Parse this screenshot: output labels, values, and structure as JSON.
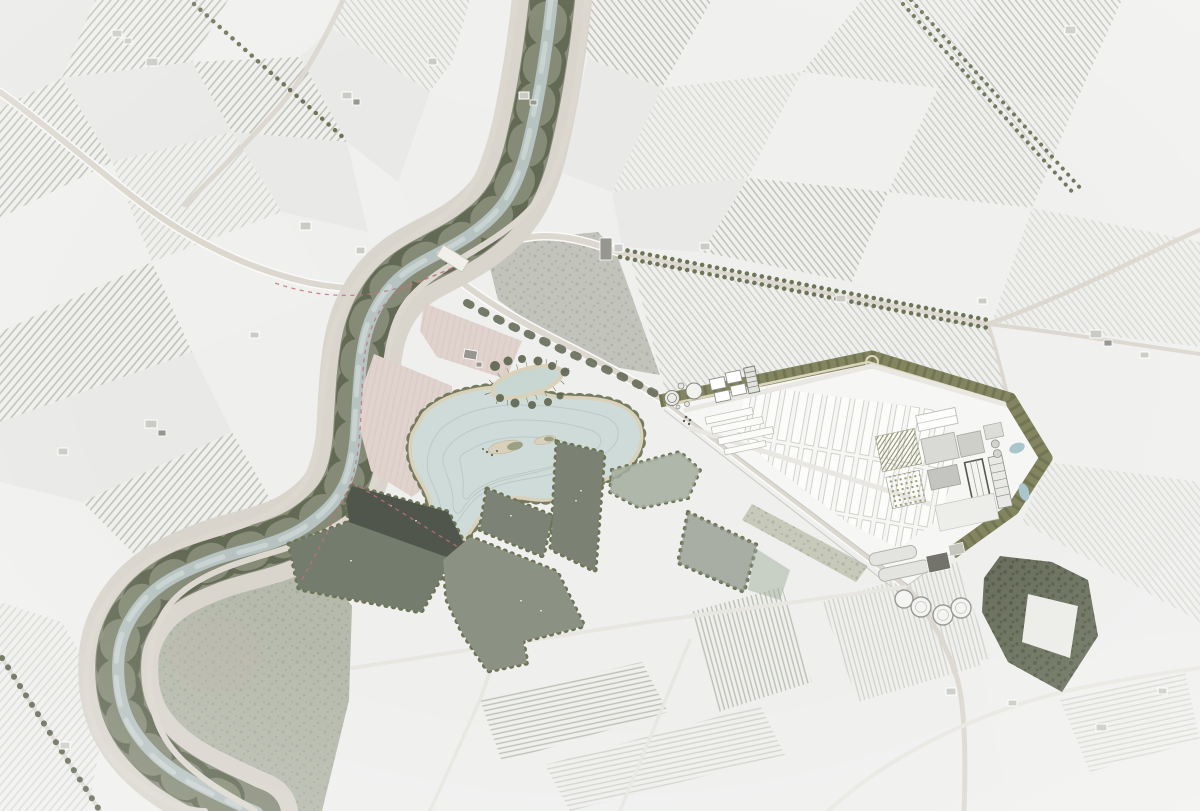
{
  "meta": {
    "title": "Aerial masterplan — river landscape with lake, wetland basins and industrial site",
    "kind": "architectural site-plan photomontage over a desaturated satellite photo",
    "visible_text": "none"
  },
  "palette": {
    "base": "#eff0ee",
    "field-light": "#f0f0ee",
    "field-light2": "#e9eae7",
    "field-mid": "#e2e3df",
    "rowline": "#bcbfb4",
    "road": "#dcd8d0",
    "roadcasing": "#fafaf8",
    "levee": "#d9d5cd",
    "river": "#b7c3c1",
    "riverlight": "#c9d3d1",
    "treedot": "#6e7557",
    "treeclump": "#5e6550",
    "treedark": "#4f5542",
    "lake": "#cfdbd8",
    "contour": "#bccac7",
    "sand": "#d9d1ba",
    "islgreen": "#8f9679",
    "pond": "#c9d7d3",
    "pink": "#e0d2cc",
    "pinkline": "#d2c2bc",
    "basin-dark": "#50564b",
    "basin-mid": "#7c8376",
    "basin-mid2": "#7b8274",
    "basin-sage": "#747c6e",
    "basin-light": "#8b9284",
    "basin-pale": "#a2ad9c",
    "meadow": "#adb2a3",
    "pasture": "#b7b8ae",
    "olive": "#82855f",
    "olivedark": "#6a6d4c",
    "site": "#f6f6f4",
    "strip": "#fcfcfa",
    "stripline": "#c0c0ba",
    "hatch": "#8f926e",
    "mottle": "#9b9c8e",
    "mottledark": "#4f5542",
    "bld": "#cbcbc6",
    "blddark": "#97978f",
    "silo": "#f4f4f2",
    "silostroke": "#9a9a95",
    "watersmall": "#a9c6cc",
    "reddash": "#c0737a"
  },
  "scene": {
    "features": [
      {
        "name": "patchwork-farm-fields",
        "kind": "vineyard and arable parcels, faded white-grey"
      },
      {
        "name": "meandering-river-corridor",
        "kind": "river with riparian woodland and levee roads"
      },
      {
        "name": "river-bridge",
        "kind": "road crossing"
      },
      {
        "name": "central-lake",
        "kind": "designed lake with contour lines and islands"
      },
      {
        "name": "ornamental-pond",
        "kind": "small tree-ringed pond north of lake"
      },
      {
        "name": "pink-tilled-fields",
        "kind": "two rose-tinted cultivated parcels"
      },
      {
        "name": "wetland-basins",
        "kind": "rectangular water cells in graded greens"
      },
      {
        "name": "cycle-route",
        "kind": "red dashed recreational path"
      },
      {
        "name": "tree-lined-avenue",
        "kind": "double row of trees from villa to site"
      },
      {
        "name": "industrial-site",
        "kind": "triangular plant with parking rows, buildings, tanks"
      },
      {
        "name": "water-treatment-tanks",
        "kind": "circular clarifiers at site tip"
      },
      {
        "name": "orchard-grid",
        "kind": "hatched planting blocks"
      },
      {
        "name": "silos",
        "kind": "four circular silos at south edge"
      },
      {
        "name": "forest-block",
        "kind": "dense woodland southeast of site"
      },
      {
        "name": "inner-bend-meadow",
        "kind": "rough meadow inside river bend"
      },
      {
        "name": "farm-building-clusters",
        "kind": "scattered farmsteads"
      }
    ],
    "counts": {
      "silos": 4,
      "wetland-basins": 8,
      "lake-islands": 2,
      "water-treatment-circles": 5,
      "pink-fields": 2
    }
  }
}
